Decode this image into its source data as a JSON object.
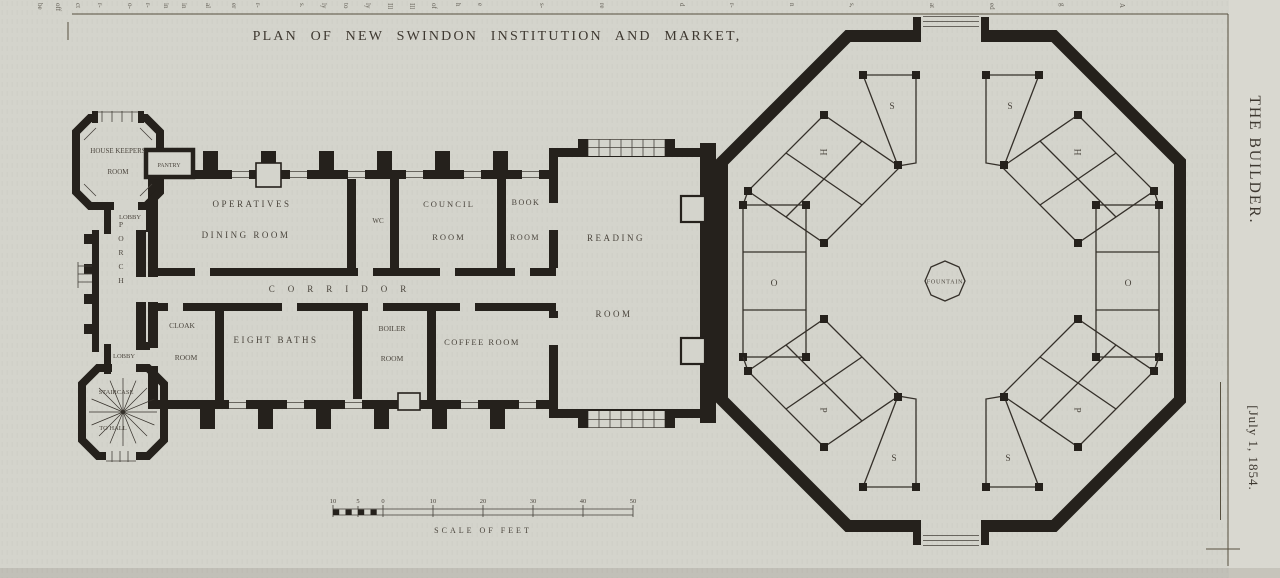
{
  "page": {
    "title": "PLAN OF NEW SWINDON INSTITUTION AND MARKET,",
    "journal": "THE BUILDER.",
    "issue_date": "[July 1, 1854.",
    "top_edge_fragments": [
      "be",
      "off",
      "ct",
      "r-",
      "o-",
      "r-",
      "in",
      "in",
      "al",
      "er",
      "r-",
      "s.",
      "ly",
      "to",
      "ly",
      "Ill",
      "Ill",
      "of",
      "h",
      "e",
      "s-",
      "re",
      "d",
      "r-",
      "n",
      "s,",
      "at",
      "ed",
      "g",
      "A"
    ]
  },
  "plan": {
    "rooms": {
      "house_keepers_line1": "HOUSE KEEPERS",
      "house_keepers_line2": "ROOM",
      "pantry": "PANTRY",
      "lobby_upper": "LOBBY",
      "porch": "PORCH",
      "lobby_lower": "LOBBY",
      "staircase": "STAIRCASE",
      "to_hall": "TO HALL",
      "operatives_line1": "OPERATIVES",
      "operatives_line2": "DINING ROOM",
      "wc": "WC",
      "council_line1": "COUNCIL",
      "council_line2": "ROOM",
      "book_line1": "BOOK",
      "book_line2": "ROOM",
      "corridor": "CORRIDOR",
      "cloak_line1": "CLOAK",
      "cloak_line2": "ROOM",
      "eight_baths": "EIGHT BATHS",
      "boiler_line1": "BOILER",
      "boiler_line2": "ROOM",
      "coffee": "COFFEE ROOM",
      "reading_line1": "READING",
      "reading_line2": "ROOM"
    },
    "market": {
      "fountain": "FOUNTAIN",
      "letters": {
        "s": "S",
        "h": "H",
        "o": "O",
        "p": "P"
      }
    },
    "scalebar": {
      "label": "SCALE OF FEET",
      "ticks": [
        "10",
        "5",
        "0",
        "10",
        "20",
        "30",
        "40",
        "50"
      ]
    }
  }
}
